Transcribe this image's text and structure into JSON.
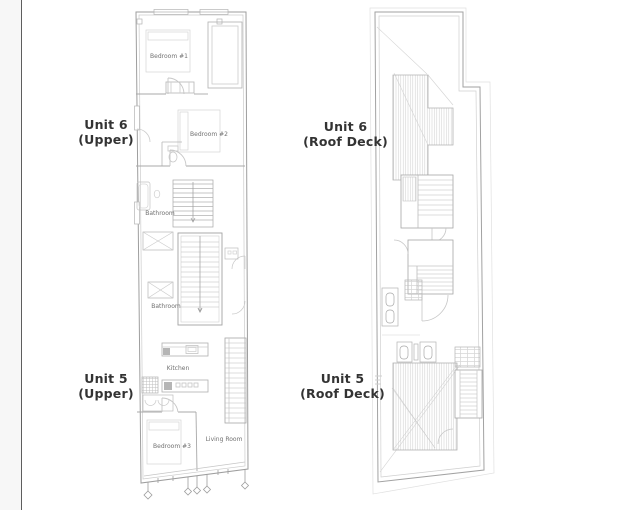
{
  "sheet": {
    "background": "#ffffff",
    "margin_strip_color": "#f7f7f7",
    "edge_line_color": "#5e5e5e",
    "wall_line_color": "#9e9e9e",
    "detail_line_color": "#c6c6c6",
    "room_label_color": "#707070",
    "unit_label_color": "#333333"
  },
  "upper_plan": {
    "units": [
      {
        "name": "Unit 6",
        "level": "(Upper)"
      },
      {
        "name": "Unit 5",
        "level": "(Upper)"
      }
    ],
    "rooms": {
      "bedroom1": "Bedroom #1",
      "bedroom2": "Bedroom #2",
      "bathroom_upper": "Bathroom",
      "bathroom_lower": "Bathroom",
      "kitchen": "Kitchen",
      "bedroom3": "Bedroom #3",
      "living_room": "Living Room"
    }
  },
  "roof_plan": {
    "units": [
      {
        "name": "Unit 6",
        "level": "(Roof Deck)"
      },
      {
        "name": "Unit 5",
        "level": "(Roof Deck)"
      }
    ]
  }
}
